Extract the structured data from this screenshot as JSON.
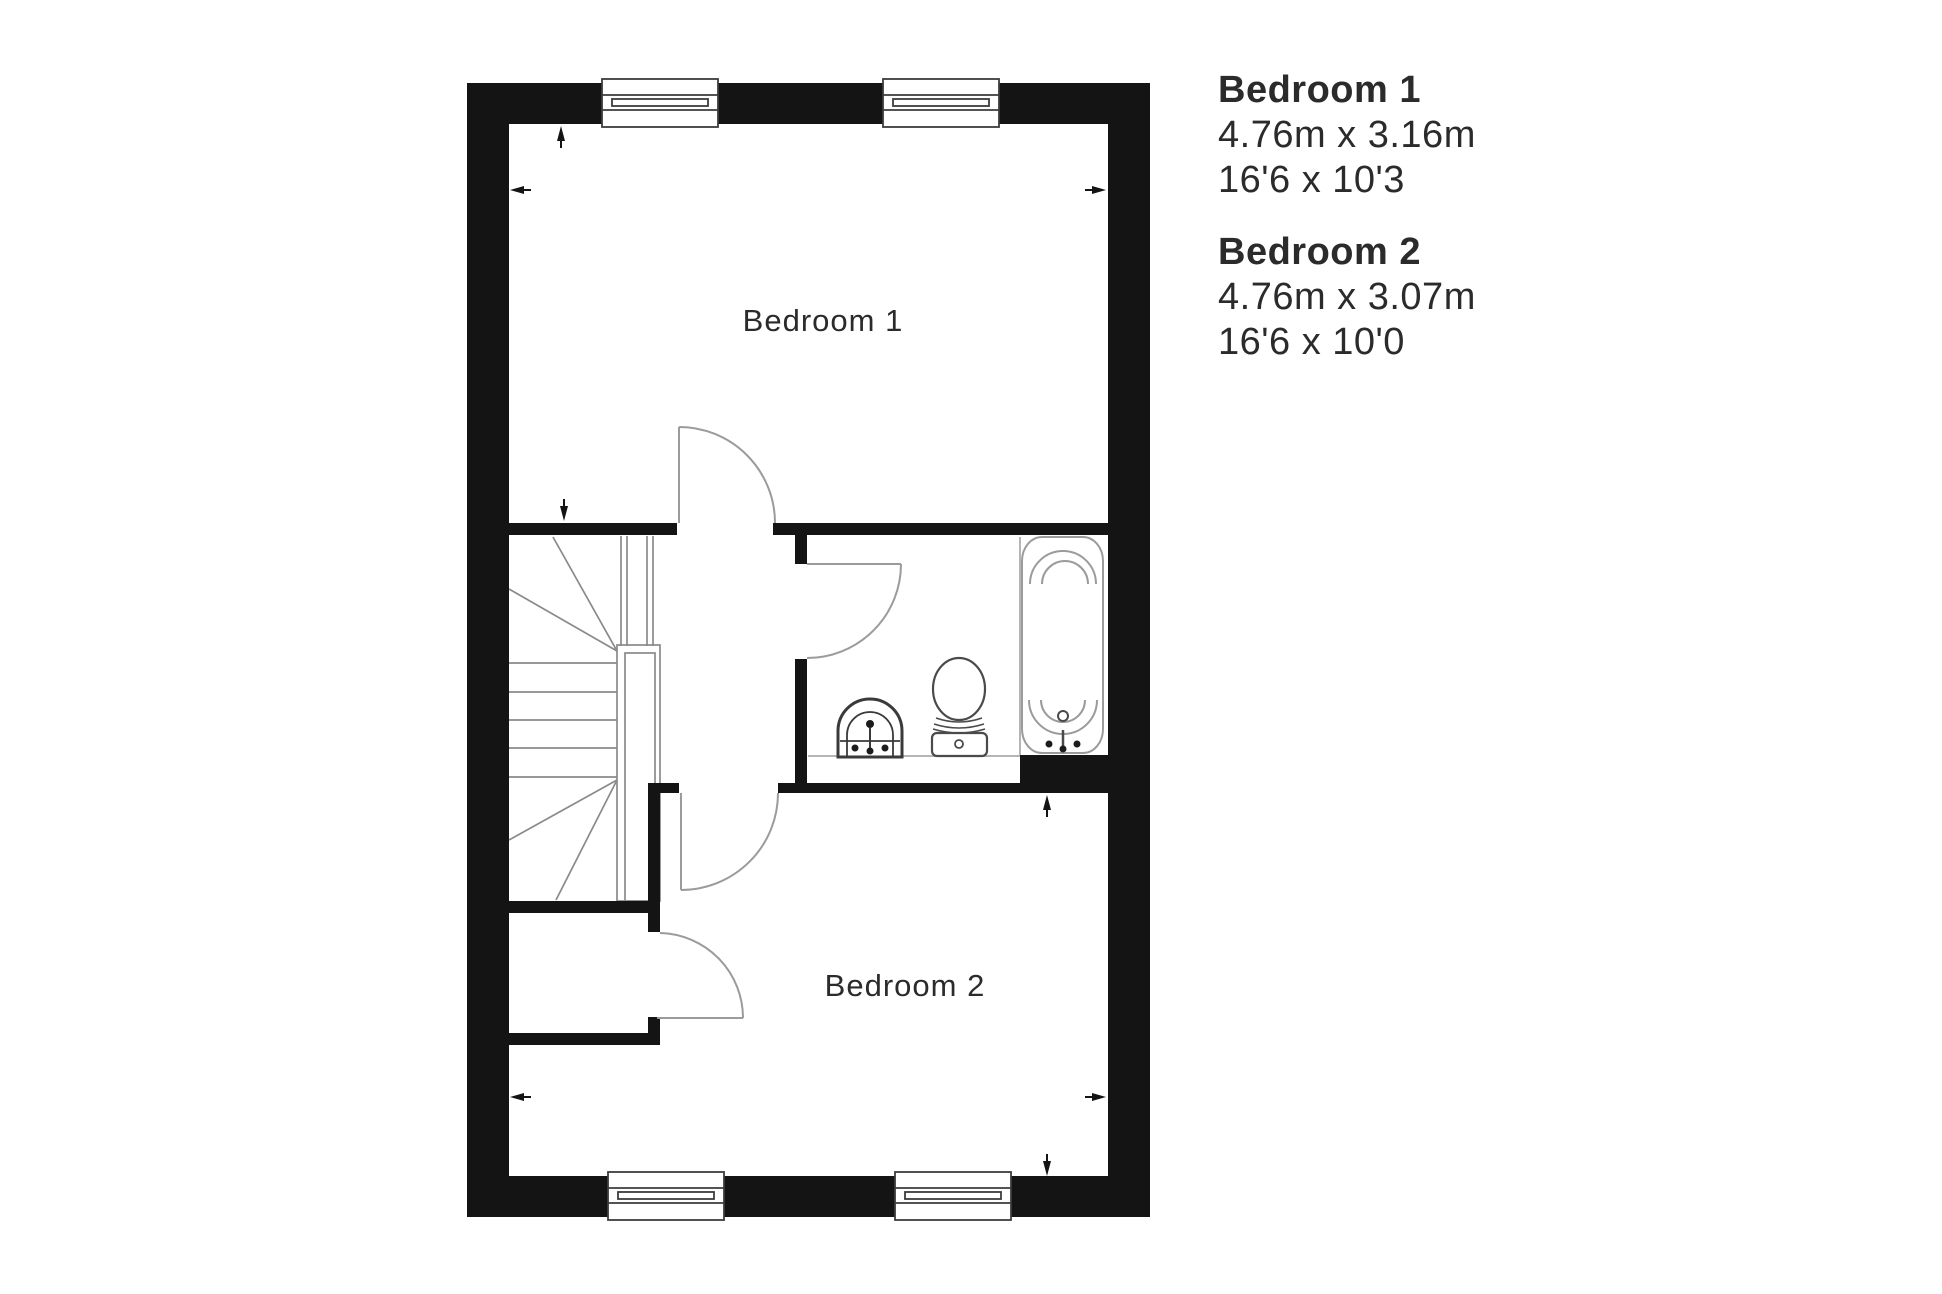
{
  "plan": {
    "room_labels": [
      {
        "id": "bedroom-1",
        "label": "Bedroom 1"
      },
      {
        "id": "bedroom-2",
        "label": "Bedroom 2"
      }
    ],
    "fixtures": [
      {
        "id": "winder-staircase"
      },
      {
        "id": "bath"
      },
      {
        "id": "toilet"
      },
      {
        "id": "sink"
      },
      {
        "id": "storage-cupboard"
      }
    ],
    "window_count": 4,
    "door_count": 4,
    "dimension_tick_count": 8
  },
  "legend": {
    "entries": [
      {
        "name": "Bedroom 1",
        "metric": "4.76m x 3.16m",
        "imperial": "16'6 x 10'3"
      },
      {
        "name": "Bedroom 2",
        "metric": "4.76m x 3.07m",
        "imperial": "16'6 x 10'0"
      }
    ]
  },
  "colors": {
    "wall": "#141414",
    "door_line": "#9b9b9b",
    "stair_line": "#8a8a8a",
    "fixture_line": "#4a4a4a",
    "ledge_line": "#b5b5b5",
    "text": "#2b2b2b",
    "background": "#ffffff"
  }
}
